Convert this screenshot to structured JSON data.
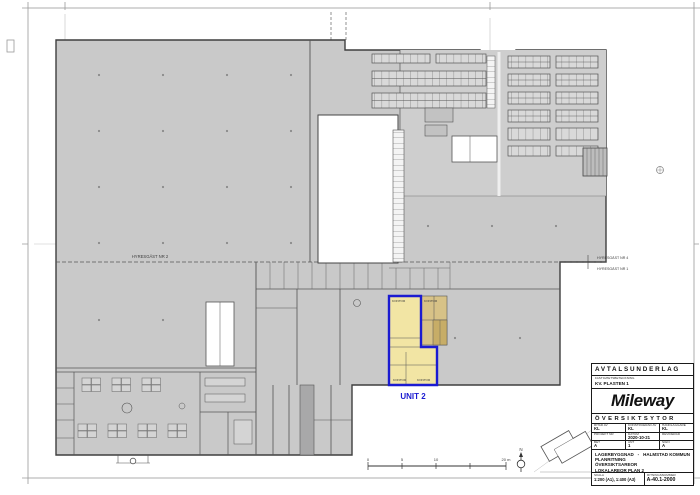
{
  "sheet": {
    "stamp": {
      "doc_type": "AVTALSUNDERLAG",
      "property_caption": "FASTIGHETSBETECKNING",
      "property": "KV. PLASTEN 1",
      "brand": "Mileway",
      "section": "ÖVERSIKTSYTOR",
      "meta_rows": [
        {
          "cells": [
            {
              "label": "RITAD AV",
              "value": "KL"
            },
            {
              "label": "KONSTRUERAD AV",
              "value": "KL"
            },
            {
              "label": "HANDLÄGGARE",
              "value": "KL"
            }
          ]
        },
        {
          "cells": [
            {
              "label": "PROJEKT NR",
              "value": ""
            },
            {
              "label": "DATUM",
              "value": "2020-10-21"
            },
            {
              "label": "REVIDERAD",
              "value": ""
            }
          ]
        },
        {
          "cells": [
            {
              "label": "BET",
              "value": "A"
            },
            {
              "label": "ANT",
              "value": "1"
            },
            {
              "label": "SIGN",
              "value": "A"
            }
          ]
        }
      ],
      "project_line_1": "LAGERBYGGNAD",
      "project_sep": "-",
      "project_line_1b": "HALMSTAD KOMMUN",
      "project_line_2": "PLANRITNING",
      "project_line_3": "ÖVERSIKTSAREOR",
      "project_line_4": "LOKALAREOR PLAN 2",
      "scale_label": "SKALA",
      "scale_value": "1:200 (A1), 1:400 (A3)",
      "number_label": "RITNINGSNUMMER",
      "number_value": "A-40.1-2000"
    },
    "plan": {
      "tenant_left": "HYRESGÄST NR 2",
      "tenant_right_top": "HYRESGÄST NR 4",
      "tenant_right_bottom": "HYRESGÄST NR 1",
      "unit_label": "UNIT 2",
      "room_kontor_top": "KONTOR",
      "room_kontor_tan": "KONTOR",
      "room_kontor_b1": "KONTOR",
      "room_kontor_b2": "KONTOR",
      "north_label": "N",
      "scale_ticks": [
        "0",
        "5",
        "10",
        "20 m"
      ]
    },
    "colors": {
      "building_fill": "#c9c9c9",
      "unit_fill": "#f2e5a4",
      "tan_fill": "#d7c287",
      "unit_outline": "#1b1bd1"
    }
  }
}
